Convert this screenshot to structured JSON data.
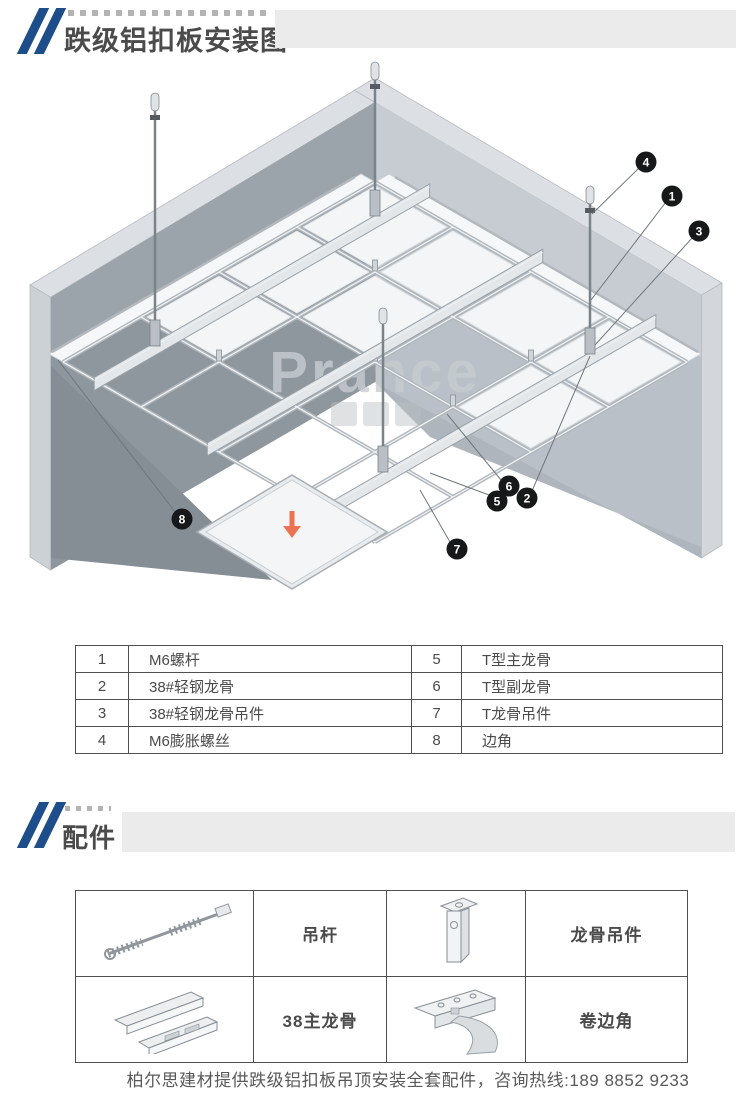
{
  "header": {
    "title": "跌级铝扣板安装图"
  },
  "diagram": {
    "watermark": "Prance",
    "callouts": [
      {
        "num": "1"
      },
      {
        "num": "2"
      },
      {
        "num": "3"
      },
      {
        "num": "4"
      },
      {
        "num": "5"
      },
      {
        "num": "6"
      },
      {
        "num": "7"
      },
      {
        "num": "8"
      }
    ],
    "arrow_color": "#ec7351"
  },
  "parts": {
    "rows": [
      {
        "n1": "1",
        "t1": "M6螺杆",
        "n2": "5",
        "t2": "T型主龙骨"
      },
      {
        "n1": "2",
        "t1": "38#轻钢龙骨",
        "n2": "6",
        "t2": "T型副龙骨"
      },
      {
        "n1": "3",
        "t1": "38#轻钢龙骨吊件",
        "n2": "7",
        "t2": "T龙骨吊件"
      },
      {
        "n1": "4",
        "t1": "M6膨胀螺丝",
        "n2": "8",
        "t2": "边角"
      }
    ]
  },
  "accessories": {
    "heading": "配件",
    "items": [
      {
        "label": "吊杆",
        "icon": "hanging-rod"
      },
      {
        "label": "龙骨吊件",
        "icon": "keel-hanger"
      },
      {
        "label": "38主龙骨",
        "icon": "main-keel-38"
      },
      {
        "label": "卷边角",
        "icon": "rolled-edge-corner"
      }
    ]
  },
  "footer": {
    "text": "柏尔思建材提供跌级铝扣板吊顶安装全套配件，咨询热线:189 8852 9233"
  },
  "colors": {
    "accent_blue": "#1d4e89",
    "callout_bg": "#17181a",
    "bar_gray": "#ebebeb"
  }
}
